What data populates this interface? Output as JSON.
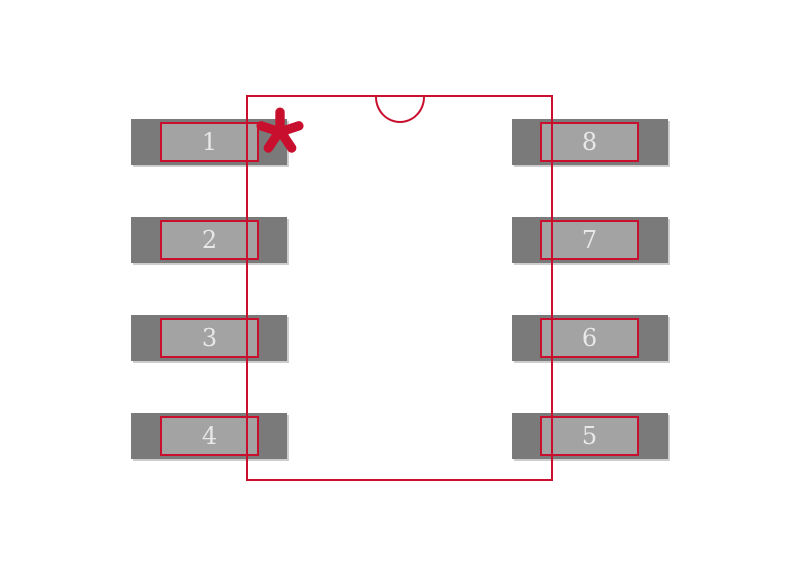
{
  "diagram": {
    "title": "8-pin package land pattern footprint",
    "colors": {
      "background": "#ffffff",
      "outline": "#c8102e",
      "pad": "#7a7a7a",
      "pin_fill": "#a3a3a3",
      "pad_shadow": "#cdcdcd",
      "number": "#e8e8e8"
    },
    "pin1_marker": "asterisk-icon",
    "notch": "top-center-semicircle"
  },
  "pads": [
    {
      "number": "1",
      "side": "left",
      "row": 0
    },
    {
      "number": "2",
      "side": "left",
      "row": 1
    },
    {
      "number": "3",
      "side": "left",
      "row": 2
    },
    {
      "number": "4",
      "side": "left",
      "row": 3
    },
    {
      "number": "8",
      "side": "right",
      "row": 0
    },
    {
      "number": "7",
      "side": "right",
      "row": 1
    },
    {
      "number": "6",
      "side": "right",
      "row": 2
    },
    {
      "number": "5",
      "side": "right",
      "row": 3
    }
  ]
}
